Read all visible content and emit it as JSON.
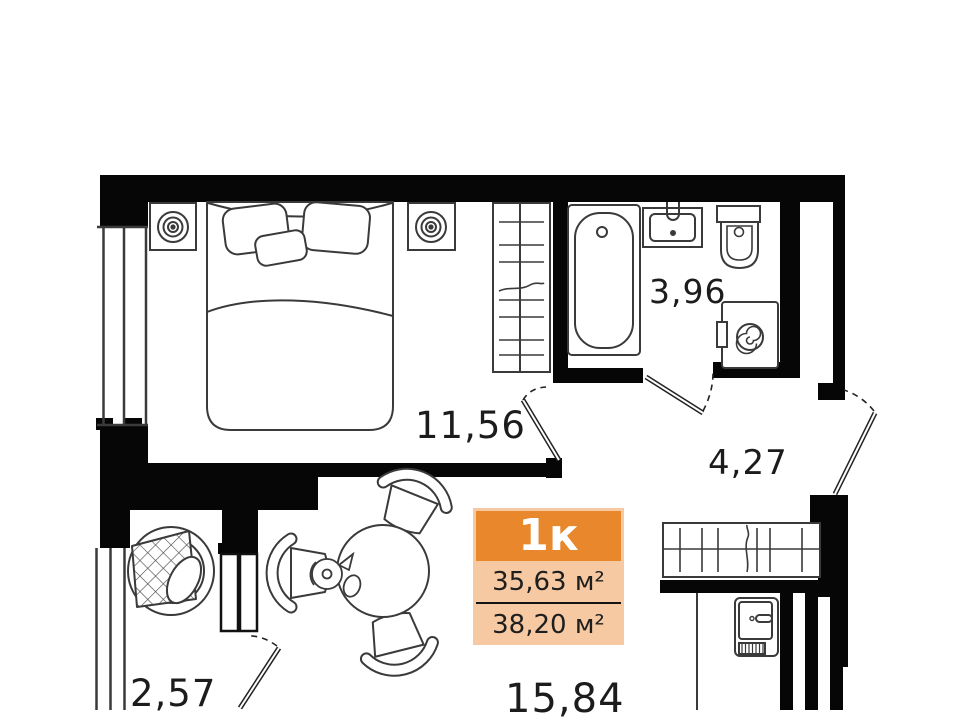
{
  "unit_card": {
    "type_label": "1к",
    "living_area": "35,63 м²",
    "total_area": "38,20 м²"
  },
  "room_labels": {
    "bedroom": "11,56",
    "bathroom": "3,96",
    "hallway": "4,27",
    "balcony": "2,57",
    "kitchen_living": "15,84"
  },
  "colors": {
    "badge_header": "#E8872B",
    "badge_body": "#F6C9A2",
    "badge_text_dark": "#1E1E1E",
    "badge_type_text": "#FFFFFF",
    "wall": "#060606",
    "furniture_line": "#3A3A3A",
    "label_text": "#1C1C1C"
  },
  "furniture_icons": [
    "double-bed-icon",
    "pillow-icon",
    "nightstand-lamp-icon",
    "shelf-wardrobe-icon",
    "bathtub-icon",
    "wash-basin-icon",
    "toilet-icon",
    "washing-machine-icon",
    "hallway-closet-icon",
    "refrigerator-icon",
    "dining-table-icon",
    "chair-icon",
    "teapot-icon",
    "wicker-armchair-icon",
    "window-icon",
    "door-swing-icon"
  ]
}
